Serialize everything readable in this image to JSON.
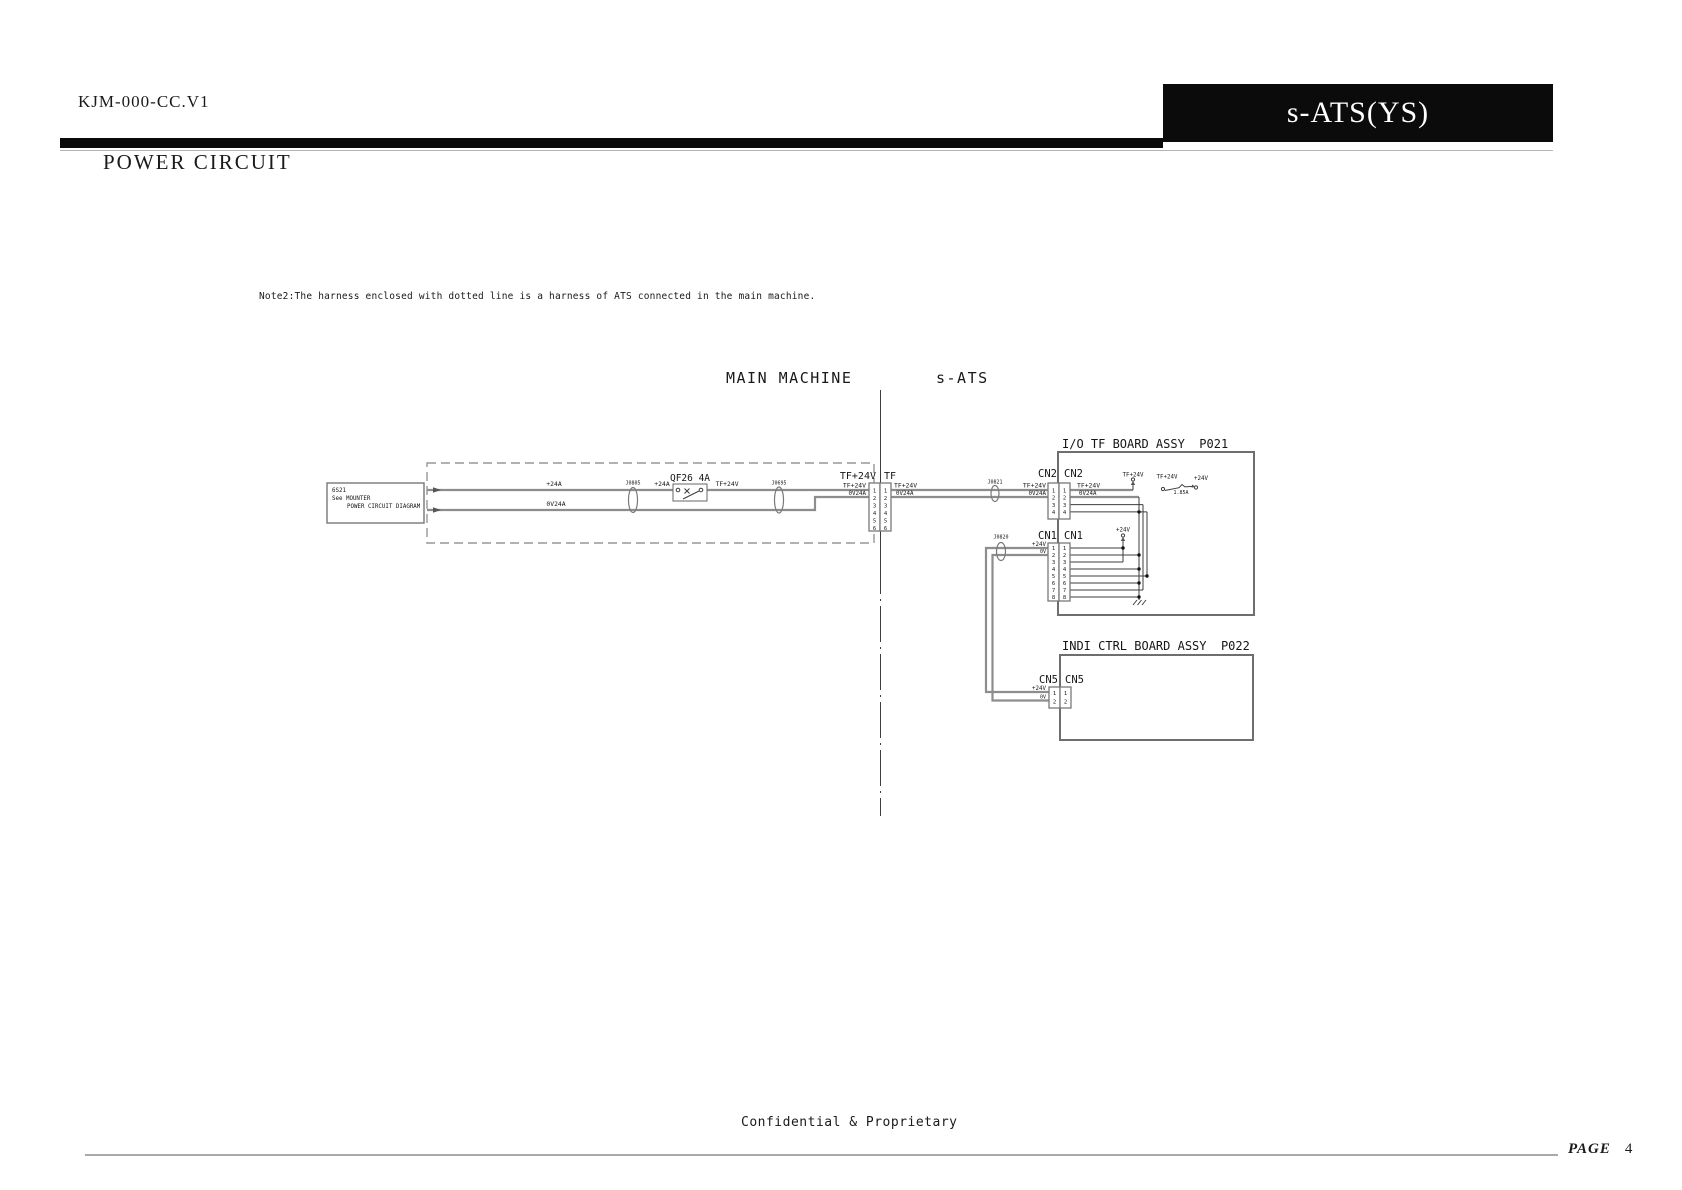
{
  "header": {
    "doc_id": "KJM-000-CC.V1",
    "model_badge": "s-ATS(YS)",
    "section_title": "POWER CIRCUIT"
  },
  "note": "Note2:The harness enclosed with dotted line is a harness of ATS connected in the main machine.",
  "zones": {
    "main_machine": "MAIN MACHINE",
    "s_ats": "s-ATS"
  },
  "diagram": {
    "source_box": {
      "line1": "6S21",
      "line2": "See MOUNTER",
      "line3": "POWER CIRCUIT DIAGRAM"
    },
    "labels": {
      "p24a": "+24A",
      "ov24a": "0V24A",
      "tf24v": "TF+24V",
      "p24v": "+24V",
      "ov": "0V",
      "breaker": "QF26 4A",
      "fuse_rating": "1.85A"
    },
    "connectors": {
      "j0805": "J0805",
      "j0695": "J0695",
      "j0821": "J0821",
      "j0820": "J0820"
    },
    "tf": {
      "left": "TF+24V",
      "right": "TF",
      "pins": [
        "1",
        "2",
        "3",
        "4",
        "5",
        "6"
      ]
    },
    "io_board": {
      "title": "I/O TF BOARD ASSY  P021",
      "cn2": "CN2",
      "cn2_pins": [
        "1",
        "2",
        "3",
        "4"
      ],
      "cn1": "CN1",
      "cn1_pins": [
        "1",
        "2",
        "3",
        "4",
        "5",
        "6",
        "7",
        "8"
      ]
    },
    "indi_board": {
      "title": "INDI CTRL BOARD ASSY  P022",
      "cn5": "CN5",
      "cn5_pins": [
        "1",
        "2"
      ]
    }
  },
  "footer": {
    "confidential": "Confidential & Proprietary",
    "page_label": "PAGE",
    "page_number": "4"
  },
  "colors": {
    "banner": "#0b0b0b",
    "power_wire": "#8d8d8d",
    "signal_wire": "#3d3d3d"
  }
}
